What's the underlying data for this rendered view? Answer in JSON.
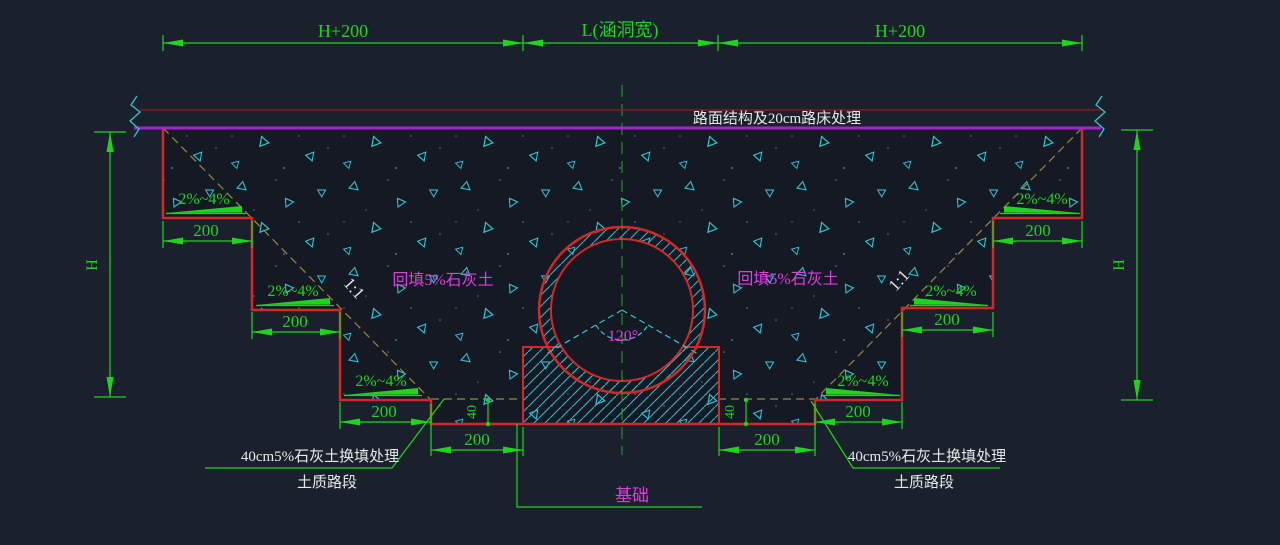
{
  "drawing_type": "culvert-backfill-cross-section",
  "colors": {
    "background": "#1b212c",
    "fill_background": "#141923",
    "excavation_red": "#d52727",
    "road_structure_dark_red": "#7c1e1e",
    "pavement_magenta_line": "#a524cd",
    "dimension_green": "#1ed41e",
    "soil_symbol_cyan": "#2cc4d4",
    "slope_line_olive": "#9a8a40",
    "label_magenta": "#e03ce0",
    "note_white": "#e8e8e8"
  },
  "top_dimensions": {
    "left": "H+200",
    "center": "L(涵洞宽)",
    "right": "H+200"
  },
  "road_note": "路面结构及20cm路床处理",
  "height_dims": {
    "left": "H",
    "right": "H"
  },
  "slope_ratios": {
    "left": "1:1",
    "right": "1:1"
  },
  "slope_grades": {
    "left_1": "2%~4%",
    "left_2": "2%~4%",
    "left_3": "2%~4%",
    "right_1": "2%~4%",
    "right_2": "2%~4%",
    "right_3": "2%~4%"
  },
  "step_dims": {
    "left_1": "200",
    "left_2": "200",
    "left_3": "200",
    "right_1": "200",
    "right_2": "200",
    "right_3": "200",
    "bottom_left": "200",
    "bottom_right": "200"
  },
  "depth_dims": {
    "left": "40",
    "right": "40"
  },
  "backfill_labels": {
    "left": "回填5%石灰土",
    "right": "回填5%石灰土"
  },
  "angle_label": "120°",
  "foundation_label": "基础",
  "replacement_notes": {
    "left": {
      "line1": "40cm5%石灰土换填处理",
      "line2": "土质路段"
    },
    "right": {
      "line1": "40cm5%石灰土换填处理",
      "line2": "土质路段"
    }
  }
}
